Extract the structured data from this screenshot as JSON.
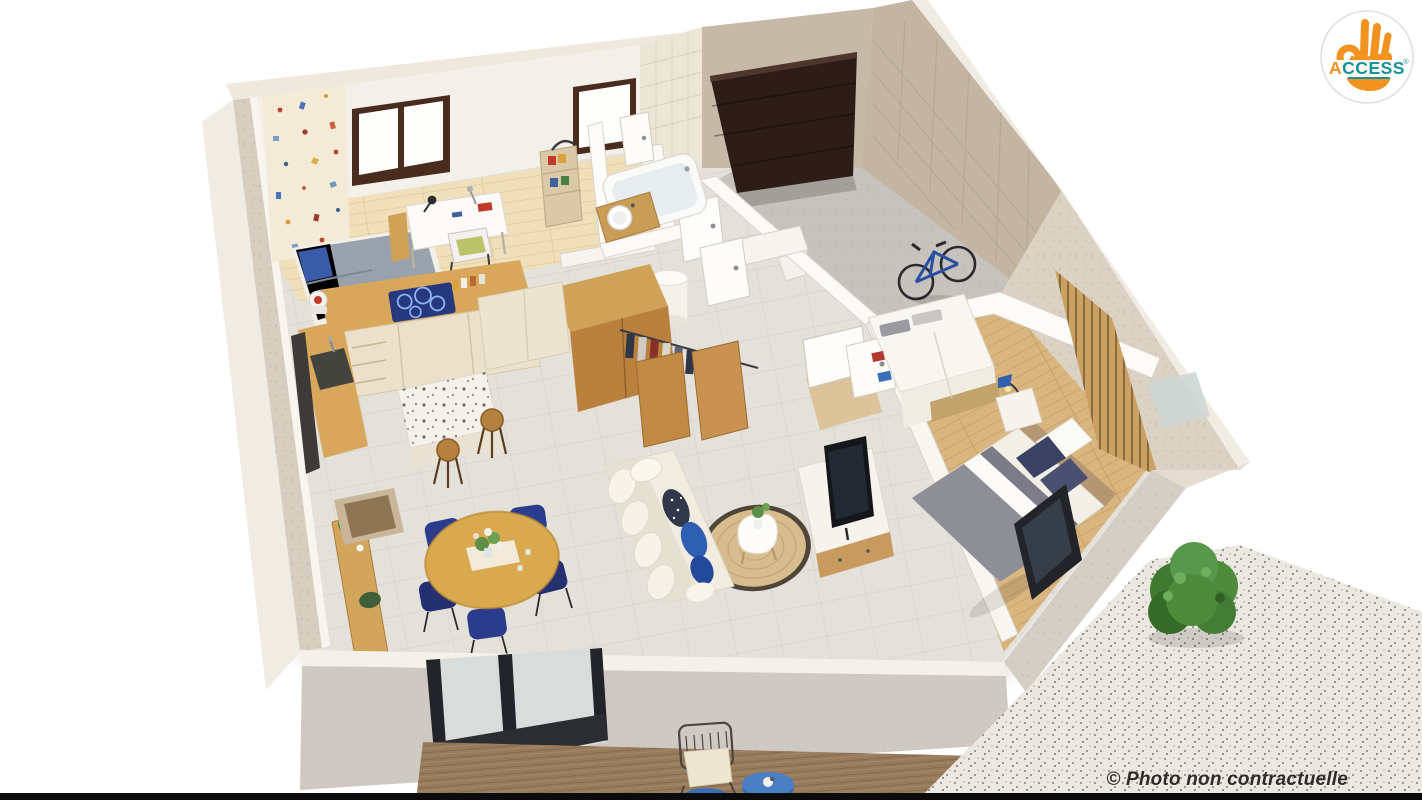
{
  "watermark": {
    "caption": "© Photo non contractuelle"
  },
  "logo": {
    "icon": "ok-hand-icon",
    "brand_first": "A",
    "brand_rest": "CCESS",
    "registered": "®"
  },
  "colors": {
    "logo_orange": "#f29220",
    "logo_teal": "#15939e",
    "caption": "#2e2b28",
    "navy": "#2c3c8c",
    "royal_blue": "#2e5fb0",
    "cooktop_blue": "#26397f",
    "wood": "#d8a75b",
    "oak_dark": "#b9803e",
    "slat_wood": "#caa162",
    "bedroom_floor": "#d9b57f",
    "kid_floor": "#efdfba",
    "tile_floor": "#e4e1db",
    "garage_floor": "#c6c2bd",
    "garage_door": "#2e1d17",
    "brick": "#c7b9a7",
    "travertine": "#dcd2c3",
    "wall_white": "#f7f4ef",
    "wall_tile": "#ece6d6",
    "front_wall": "#cfc9c4",
    "deck": "#977b5c",
    "gravel": "#ebe8e2",
    "jute": "#d7bd8e",
    "sofa": "#f1ecdf",
    "plant_green": "#4e8c3b",
    "blanket_gray": "#8e8e97"
  }
}
